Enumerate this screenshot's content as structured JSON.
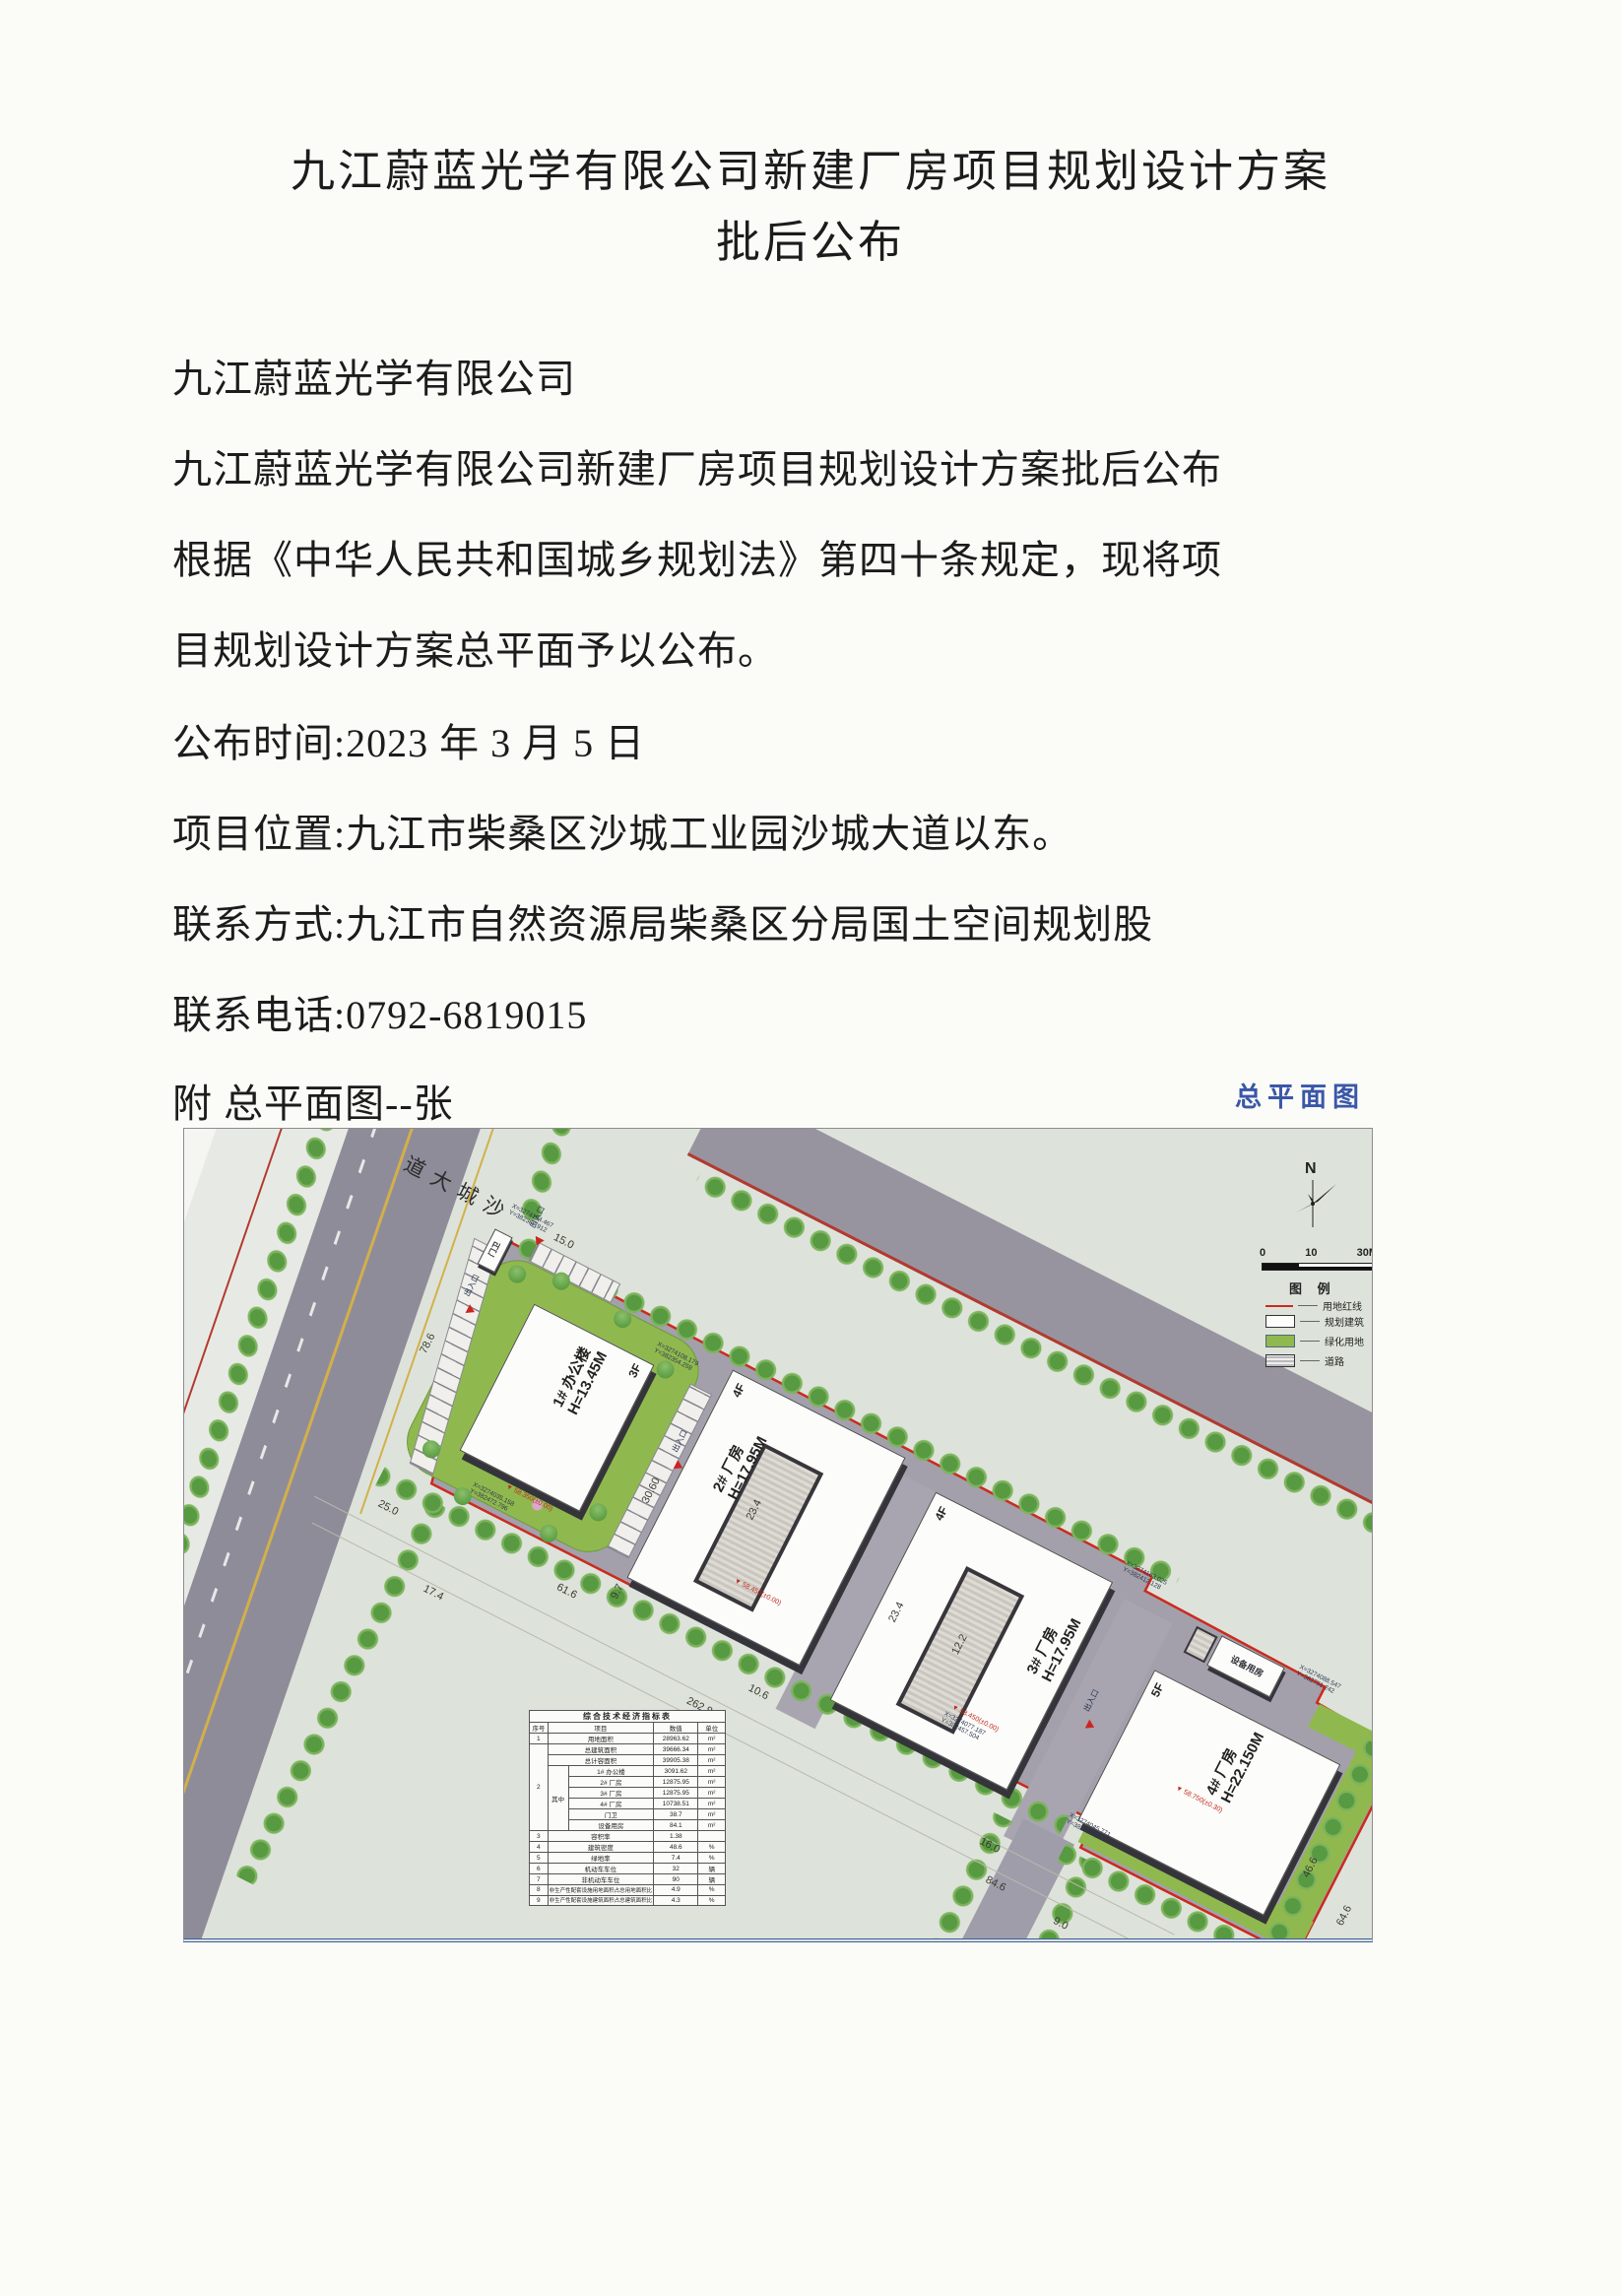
{
  "document": {
    "title_line1": "九江蔚蓝光学有限公司新建厂房项目规划设计方案",
    "title_line2": "批后公布",
    "paragraphs": [
      "九江蔚蓝光学有限公司",
      "九江蔚蓝光学有限公司新建厂房项目规划设计方案批后公布",
      "根据《中华人民共和国城乡规划法》第四十条规定，现将项",
      "目规划设计方案总平面予以公布。",
      "公布时间:2023 年 3 月 5 日",
      "项目位置:九江市柴桑区沙城工业园沙城大道以东。",
      "联系方式:九江市自然资源局柴桑区分局国土空间规划股",
      "联系电话:0792-6819015",
      "附  总平面图--张"
    ]
  },
  "plan": {
    "caption": "总平面图",
    "north_label": "N",
    "scale": {
      "t0": "0",
      "t1": "10",
      "t2": "30M"
    },
    "legend": {
      "title": "图 例",
      "items": [
        {
          "label": "用地红线"
        },
        {
          "label": "规划建筑"
        },
        {
          "label": "绿化用地"
        },
        {
          "label": "道路"
        }
      ]
    },
    "road_name": "沙城大道",
    "gatehouse": "门卫",
    "equipment_room": "设备用房",
    "entrance": "出入口",
    "buildings": [
      {
        "floors": "3F",
        "name": "1# 办公楼",
        "height": "H=13.45M"
      },
      {
        "floors": "4F",
        "name": "2# 厂房",
        "height": "H=17.95M"
      },
      {
        "floors": "4F",
        "name": "3# 厂房",
        "height": "H=17.95M"
      },
      {
        "floors": "5F",
        "name": "4# 厂房",
        "height": "H=22.150M"
      }
    ],
    "elevations": [
      {
        "t": "▼ 58.350(±0.00)"
      },
      {
        "t": "▼ 58.450(±0.00)"
      },
      {
        "t": "▼ 58.450(±0.00)"
      },
      {
        "t": "▼ 58.750(±0.30)"
      }
    ],
    "dims": [
      {
        "t": "78.6"
      },
      {
        "t": "15.0"
      },
      {
        "t": "25.0"
      },
      {
        "t": "17.4"
      },
      {
        "t": "61.6"
      },
      {
        "t": "9.7"
      },
      {
        "t": "10.6"
      },
      {
        "t": "262.8"
      },
      {
        "t": "84.6"
      },
      {
        "t": "23.4"
      },
      {
        "t": "12.2"
      },
      {
        "t": "23.4"
      },
      {
        "t": "30.60"
      },
      {
        "t": "46.6"
      },
      {
        "t": "64.6"
      },
      {
        "t": "16.0"
      },
      {
        "t": "9.0"
      }
    ],
    "coords": [
      {
        "x": "X=3274194.467",
        "y": "Y=382367.912"
      },
      {
        "x": "X=3274163.025",
        "y": "Y=382412.128"
      },
      {
        "x": "X=3274088.547",
        "y": "Y=382751.242"
      },
      {
        "x": "X=3274077.187",
        "y": "Y=382457.504"
      },
      {
        "x": "X=3274045.771",
        "y": "Y=382525.874"
      },
      {
        "x": "X=3274035.158",
        "y": "Y=382472.796"
      },
      {
        "x": "X=3274108.179",
        "y": "Y=382354.259"
      }
    ],
    "table": {
      "title": "综合技术经济指标表",
      "headers": {
        "no": "序号",
        "item": "项目",
        "value": "数值",
        "unit": "单位"
      },
      "zhong": "其中",
      "rows": [
        {
          "no": "1",
          "item": "用地面积",
          "value": "28963.62",
          "unit": "m²"
        },
        {
          "no": "2",
          "item": "总建筑面积",
          "value": "39666.34",
          "unit": "m²"
        },
        {
          "no": "",
          "item": "总计容面积",
          "value": "39905.38",
          "unit": "m²"
        },
        {
          "no": "",
          "item": "1# 办公楼",
          "value": "3091.62",
          "unit": "m²"
        },
        {
          "no": "",
          "item": "2# 厂房",
          "value": "12875.95",
          "unit": "m²"
        },
        {
          "no": "",
          "item": "3# 厂房",
          "value": "12875.95",
          "unit": "m²"
        },
        {
          "no": "",
          "item": "4# 厂房",
          "value": "10738.51",
          "unit": "m²"
        },
        {
          "no": "",
          "item": "门卫",
          "value": "38.7",
          "unit": "m²"
        },
        {
          "no": "",
          "item": "设备用房",
          "value": "84.1",
          "unit": "m²"
        },
        {
          "no": "3",
          "item": "容积率",
          "value": "1.38",
          "unit": ""
        },
        {
          "no": "4",
          "item": "建筑密度",
          "value": "48.6",
          "unit": "%"
        },
        {
          "no": "5",
          "item": "绿地率",
          "value": "7.4",
          "unit": "%"
        },
        {
          "no": "6",
          "item": "机动车车位",
          "value": "32",
          "unit": "辆"
        },
        {
          "no": "7",
          "item": "非机动车车位",
          "value": "90",
          "unit": "辆"
        },
        {
          "no": "8",
          "item": "非生产性配套设施用地面积占总用地面积比",
          "value": "4.9",
          "unit": "%"
        },
        {
          "no": "9",
          "item": "非生产性配套设施建筑面积占总建筑面积比",
          "value": "4.3",
          "unit": "%"
        }
      ]
    }
  }
}
